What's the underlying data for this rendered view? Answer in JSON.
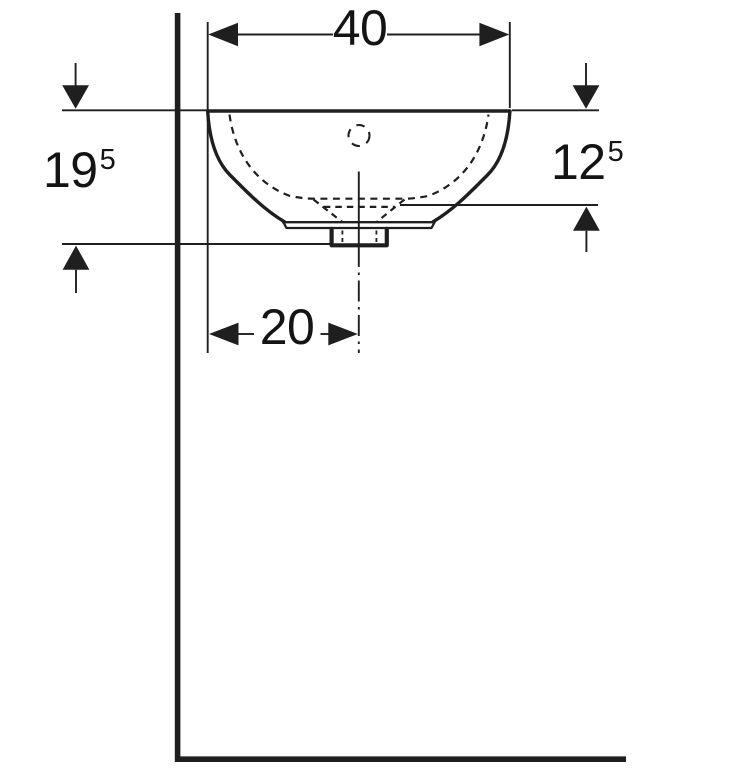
{
  "drawing": {
    "kind": "technical-dimension-drawing",
    "view": "washbasin-front-elevation",
    "dimensions": {
      "top_width": {
        "value": "40"
      },
      "left_height": {
        "value": "19",
        "sup": "5"
      },
      "right_depth": {
        "value": "12",
        "sup": "5"
      },
      "bottom_width": {
        "value": "20"
      }
    },
    "colors": {
      "line": "#1f1f1f",
      "text": "#141414",
      "background": "#ffffff"
    }
  }
}
